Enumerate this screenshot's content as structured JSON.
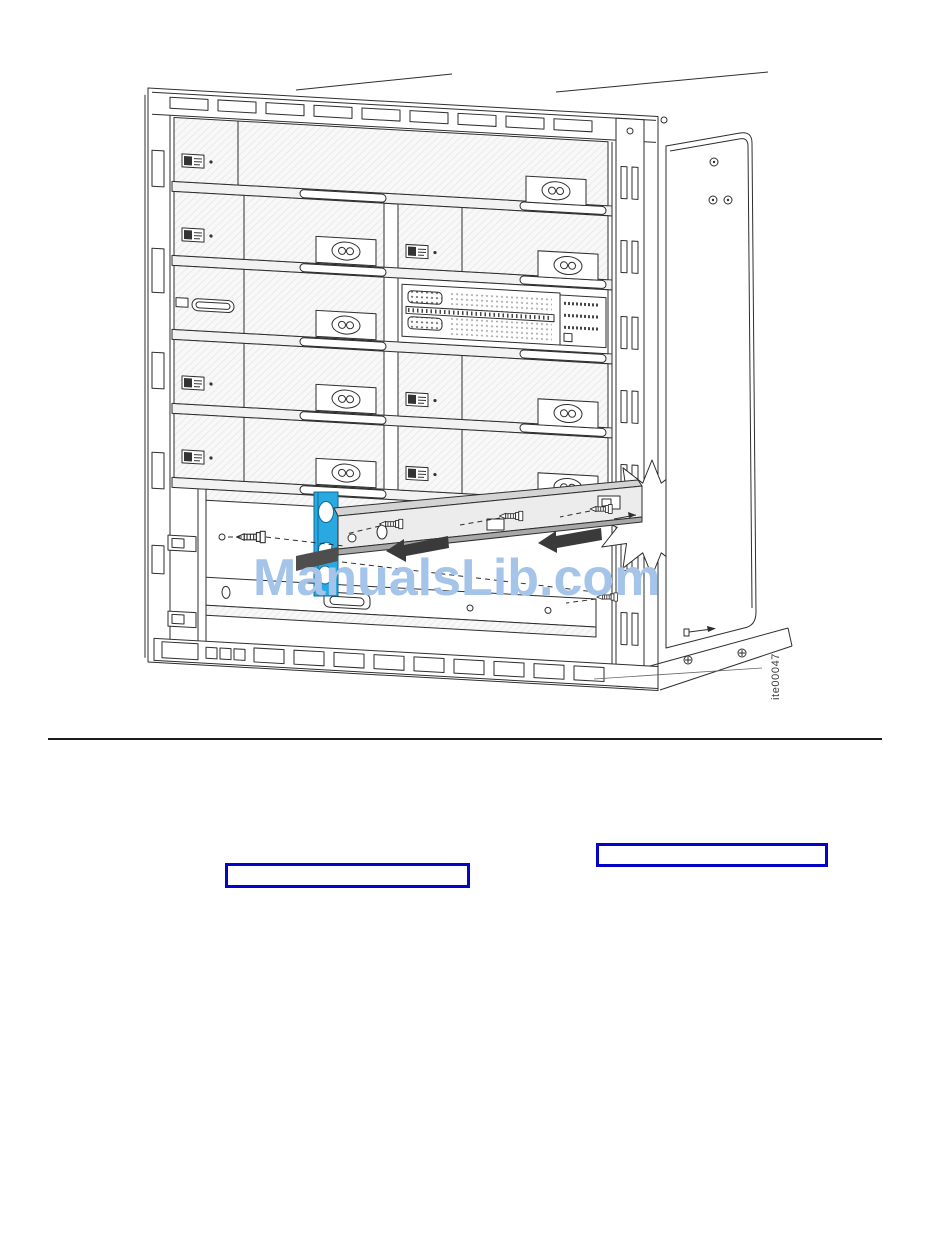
{
  "window": {
    "width": 950,
    "height": 1260,
    "background": "#ffffff"
  },
  "watermark": {
    "text": "ManualsLib.com"
  },
  "figure": {
    "caption_id": "ite00047"
  },
  "links": [
    {
      "label": ""
    },
    {
      "label": ""
    }
  ],
  "icons": {
    "removal-arrow-icon": "⬅",
    "screw-icon": "⊢",
    "starburst-icon": "✷",
    "latch-icon": "⊙"
  },
  "colors": {
    "link-border": "#0505c8",
    "highlight-blue": "#2aa9e1",
    "highlight-blue-dark": "#0b6a9e",
    "watermark-blue": "#a5c4e9",
    "arrow-dark": "#3a3a3a",
    "line-dark": "#2e2e2e"
  }
}
